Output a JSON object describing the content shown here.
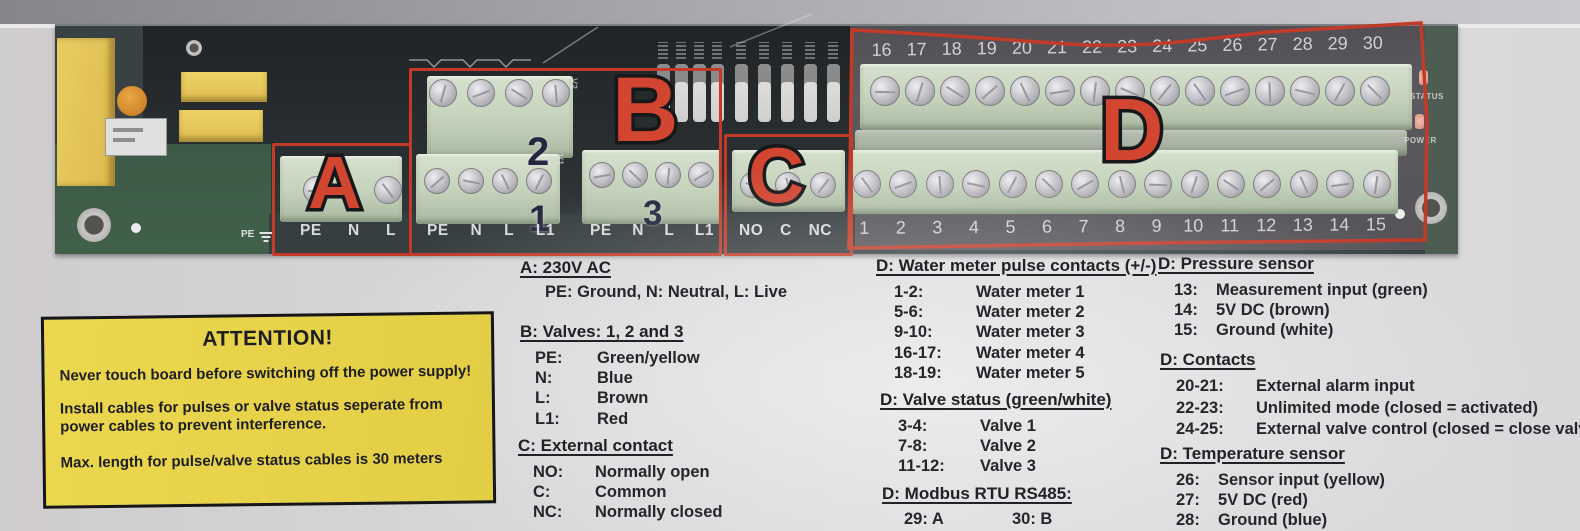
{
  "photo": {
    "board": {
      "region_letters": {
        "a": "A",
        "b": "B",
        "c": "C",
        "d": "D"
      },
      "valve_block_numbers": {
        "top": "2",
        "bottom_left": "1",
        "bottom_right": "3"
      },
      "terminal_labels": {
        "a": [
          "PE",
          "N",
          "L"
        ],
        "b1": [
          "PE",
          "N",
          "L",
          "L1"
        ],
        "b3": [
          "PE",
          "N",
          "L",
          "L1"
        ],
        "c": [
          "NO",
          "C",
          "NC"
        ]
      },
      "d_top_numbers": [
        "16",
        "17",
        "18",
        "19",
        "20",
        "21",
        "22",
        "23",
        "24",
        "25",
        "26",
        "27",
        "28",
        "29",
        "30"
      ],
      "d_bottom_numbers": [
        "1",
        "2",
        "3",
        "4",
        "5",
        "6",
        "7",
        "8",
        "9",
        "10",
        "11",
        "12",
        "13",
        "14",
        "15"
      ],
      "silkscreen": {
        "pe": "PE",
        "v1": "V1",
        "v2": "V2",
        "status_led": "STATUS",
        "power_led": "POWER"
      }
    }
  },
  "attention": {
    "title": "ATTENTION!",
    "line1": "Never touch board before switching off the power supply!",
    "line2": "Install cables for pulses or valve status seperate from power cables to prevent interference.",
    "line3": "Max. length for pulse/valve status cables is 30 meters"
  },
  "legend": {
    "a": {
      "heading": "A: 230V AC",
      "note": "PE: Ground, N: Neutral, L: Live"
    },
    "b": {
      "heading": "B: Valves: 1, 2 and 3",
      "rows": [
        {
          "k": "PE:",
          "v": "Green/yellow"
        },
        {
          "k": "N:",
          "v": "Blue"
        },
        {
          "k": "L:",
          "v": "Brown"
        },
        {
          "k": "L1:",
          "v": "Red"
        }
      ]
    },
    "c": {
      "heading": "C: External contact",
      "rows": [
        {
          "k": "NO:",
          "v": "Normally open"
        },
        {
          "k": "C:",
          "v": "Common"
        },
        {
          "k": "NC:",
          "v": "Normally closed"
        }
      ]
    },
    "d_water": {
      "heading": "D: Water meter pulse contacts (+/-)",
      "rows": [
        {
          "k": "1-2:",
          "v": "Water meter 1"
        },
        {
          "k": "5-6:",
          "v": "Water meter 2"
        },
        {
          "k": "9-10:",
          "v": "Water meter 3"
        },
        {
          "k": "16-17:",
          "v": "Water meter 4"
        },
        {
          "k": "18-19:",
          "v": "Water meter 5"
        }
      ]
    },
    "d_valve": {
      "heading": "D: Valve status (green/white)",
      "rows": [
        {
          "k": "3-4:",
          "v": "Valve 1"
        },
        {
          "k": "7-8:",
          "v": "Valve 2"
        },
        {
          "k": "11-12:",
          "v": "Valve 3"
        }
      ]
    },
    "d_modbus": {
      "heading": "D: Modbus RTU RS485:",
      "pair_left": "29: A",
      "pair_right": "30: B"
    },
    "d_pressure": {
      "heading": "D: Pressure sensor",
      "rows": [
        {
          "k": "13:",
          "v": "Measurement input (green)"
        },
        {
          "k": "14:",
          "v": "5V DC (brown)"
        },
        {
          "k": "15:",
          "v": "Ground (white)"
        }
      ]
    },
    "d_contacts": {
      "heading": "D: Contacts",
      "rows": [
        {
          "k": "20-21:",
          "v": "External alarm input"
        },
        {
          "k": "22-23:",
          "v": "Unlimited mode (closed = activated)"
        },
        {
          "k": "24-25:",
          "v": "External valve control (closed = close valves)"
        }
      ]
    },
    "d_temperature": {
      "heading": "D: Temperature sensor",
      "rows": [
        {
          "k": "26:",
          "v": "Sensor input (yellow)"
        },
        {
          "k": "27:",
          "v": "5V DC (red)"
        },
        {
          "k": "28:",
          "v": "Ground (blue)"
        }
      ]
    }
  },
  "colors": {
    "marker_red": "#c23a28",
    "letter_red": "#d14531",
    "attention_yellow": "#e8d34c",
    "board_green": "#3e5c46",
    "terminal_green": "#c7d4bf"
  }
}
